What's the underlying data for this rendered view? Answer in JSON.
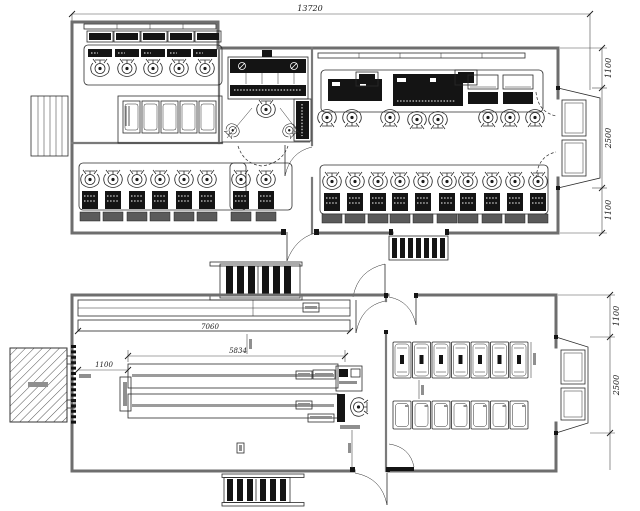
{
  "dimensions": {
    "overall_width": "13720",
    "upper_right_chain": [
      "1100",
      "2500",
      "1100"
    ],
    "lower_right_chain": [
      "1100",
      "2500"
    ],
    "lower_strip_width": "7060",
    "lower_tables_width": "5834",
    "lower_screen_offset": "1100"
  },
  "counts": {
    "upper_left_monitor_desks": 5,
    "upper_left_locker_cabinets": 5,
    "upper_left_operator_stations": 6,
    "upper_center_operator_stations": 2,
    "upper_right_console_chairs": 8,
    "upper_right_operator_stations": 10,
    "lower_bed_units": 7,
    "lower_locker_units": 7,
    "stair_flights": 3,
    "entry_vestibules": 2
  },
  "colors": {
    "line": "#2b2b2b",
    "wall": "#6e6e6e",
    "panel": "#141414",
    "background": "#ffffff"
  }
}
